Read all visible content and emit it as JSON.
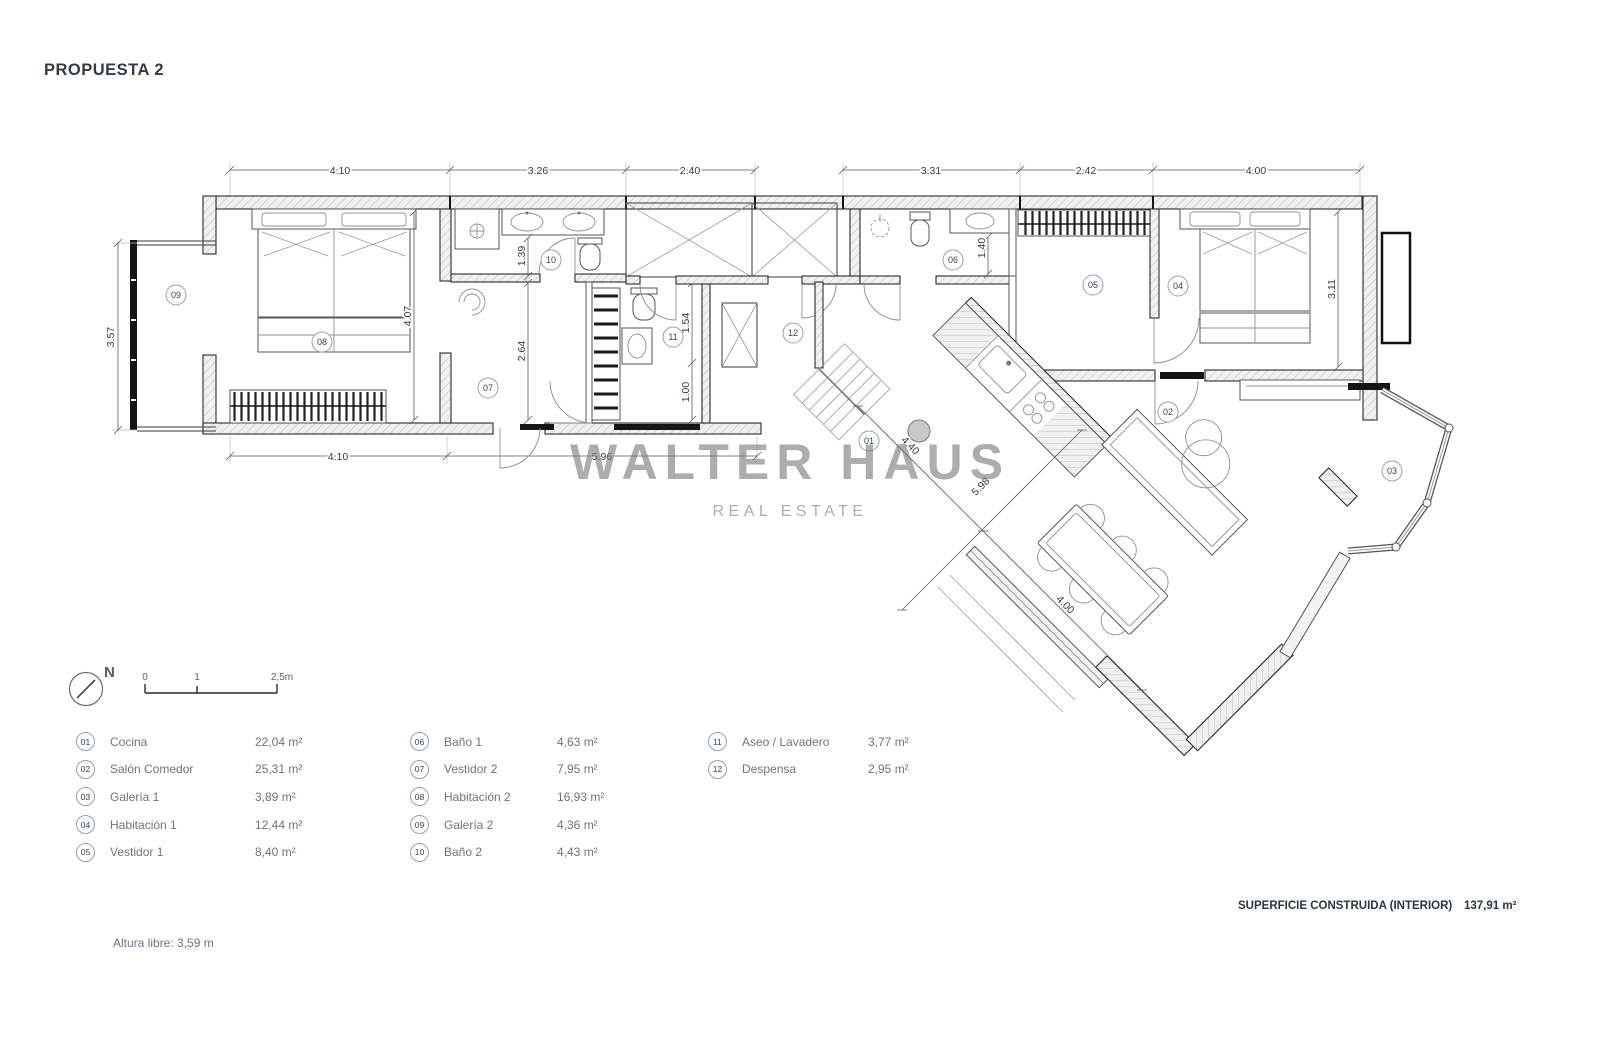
{
  "title": "PROPUESTA 2",
  "watermark": {
    "line1": "WALTER HAUS",
    "line2": "REAL ESTATE"
  },
  "north_label": "N",
  "scale_bar": {
    "t0": "0",
    "t1": "1",
    "t2": "2,5m"
  },
  "rooms": [
    {
      "id": "01",
      "name": "Cocina",
      "area": "22,04 m²"
    },
    {
      "id": "02",
      "name": "Salón Comedor",
      "area": "25,31 m²"
    },
    {
      "id": "03",
      "name": "Galería 1",
      "area": "3,89 m²"
    },
    {
      "id": "04",
      "name": "Habitación 1",
      "area": "12,44 m²"
    },
    {
      "id": "05",
      "name": "Vestidor 1",
      "area": "8,40 m²"
    },
    {
      "id": "06",
      "name": "Baño 1",
      "area": "4,63 m²"
    },
    {
      "id": "07",
      "name": "Vestidor 2",
      "area": "7,95 m²"
    },
    {
      "id": "08",
      "name": "Habitación 2",
      "area": "16,93 m²"
    },
    {
      "id": "09",
      "name": "Galería 2",
      "area": "4,36 m²"
    },
    {
      "id": "10",
      "name": "Baño 2",
      "area": "4,43 m²"
    },
    {
      "id": "11",
      "name": "Aseo / Lavadero",
      "area": "3,77 m²"
    },
    {
      "id": "12",
      "name": "Despensa",
      "area": "2,95 m²"
    }
  ],
  "dims": {
    "top": [
      "4.10",
      "3.26",
      "2.40",
      "3.31",
      "2.42",
      "4.00"
    ],
    "v_gallery2": "3.57",
    "v_room8": "4.07",
    "v_vestidor2": "2.64",
    "v_bath2": "1.39",
    "v_aseo_upper": "1.54",
    "v_aseo_lower": "1.00",
    "v_bath1": "1.40",
    "v_room4": "3.11",
    "b_room8": "4.10",
    "b_hall": "5.96",
    "d_kitchen_a": "4.40",
    "d_kitchen_b": "5.98",
    "d_salon": "4.00"
  },
  "totals": {
    "label": "SUPERFICIE CONSTRUIDA (INTERIOR)",
    "value": "137,91 m²"
  },
  "footer_note": "Altura libre: 3,59 m",
  "colors": {
    "ink": "#2a2a2a",
    "muted_text": "#6b7480",
    "watermark": "#8f8f8f"
  }
}
